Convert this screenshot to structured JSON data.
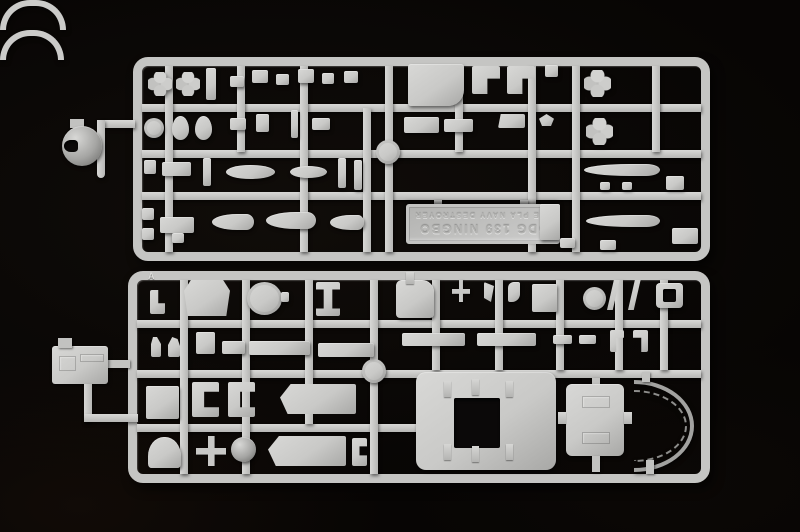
{
  "scene": {
    "colors": {
      "background": "#070504",
      "plastic": "#c9c9c7",
      "plastic_highlight": "#d8d8d6",
      "plastic_shadow": "#a8a8a6"
    },
    "sprue_top": {
      "marking_plate": {
        "line1": "DDG 139 NINGBO",
        "line2": "THE PLA NAVY DESTROYER",
        "orientation": "upside-down"
      }
    },
    "sprue_bottom": {
      "corner_letter": "A"
    }
  }
}
